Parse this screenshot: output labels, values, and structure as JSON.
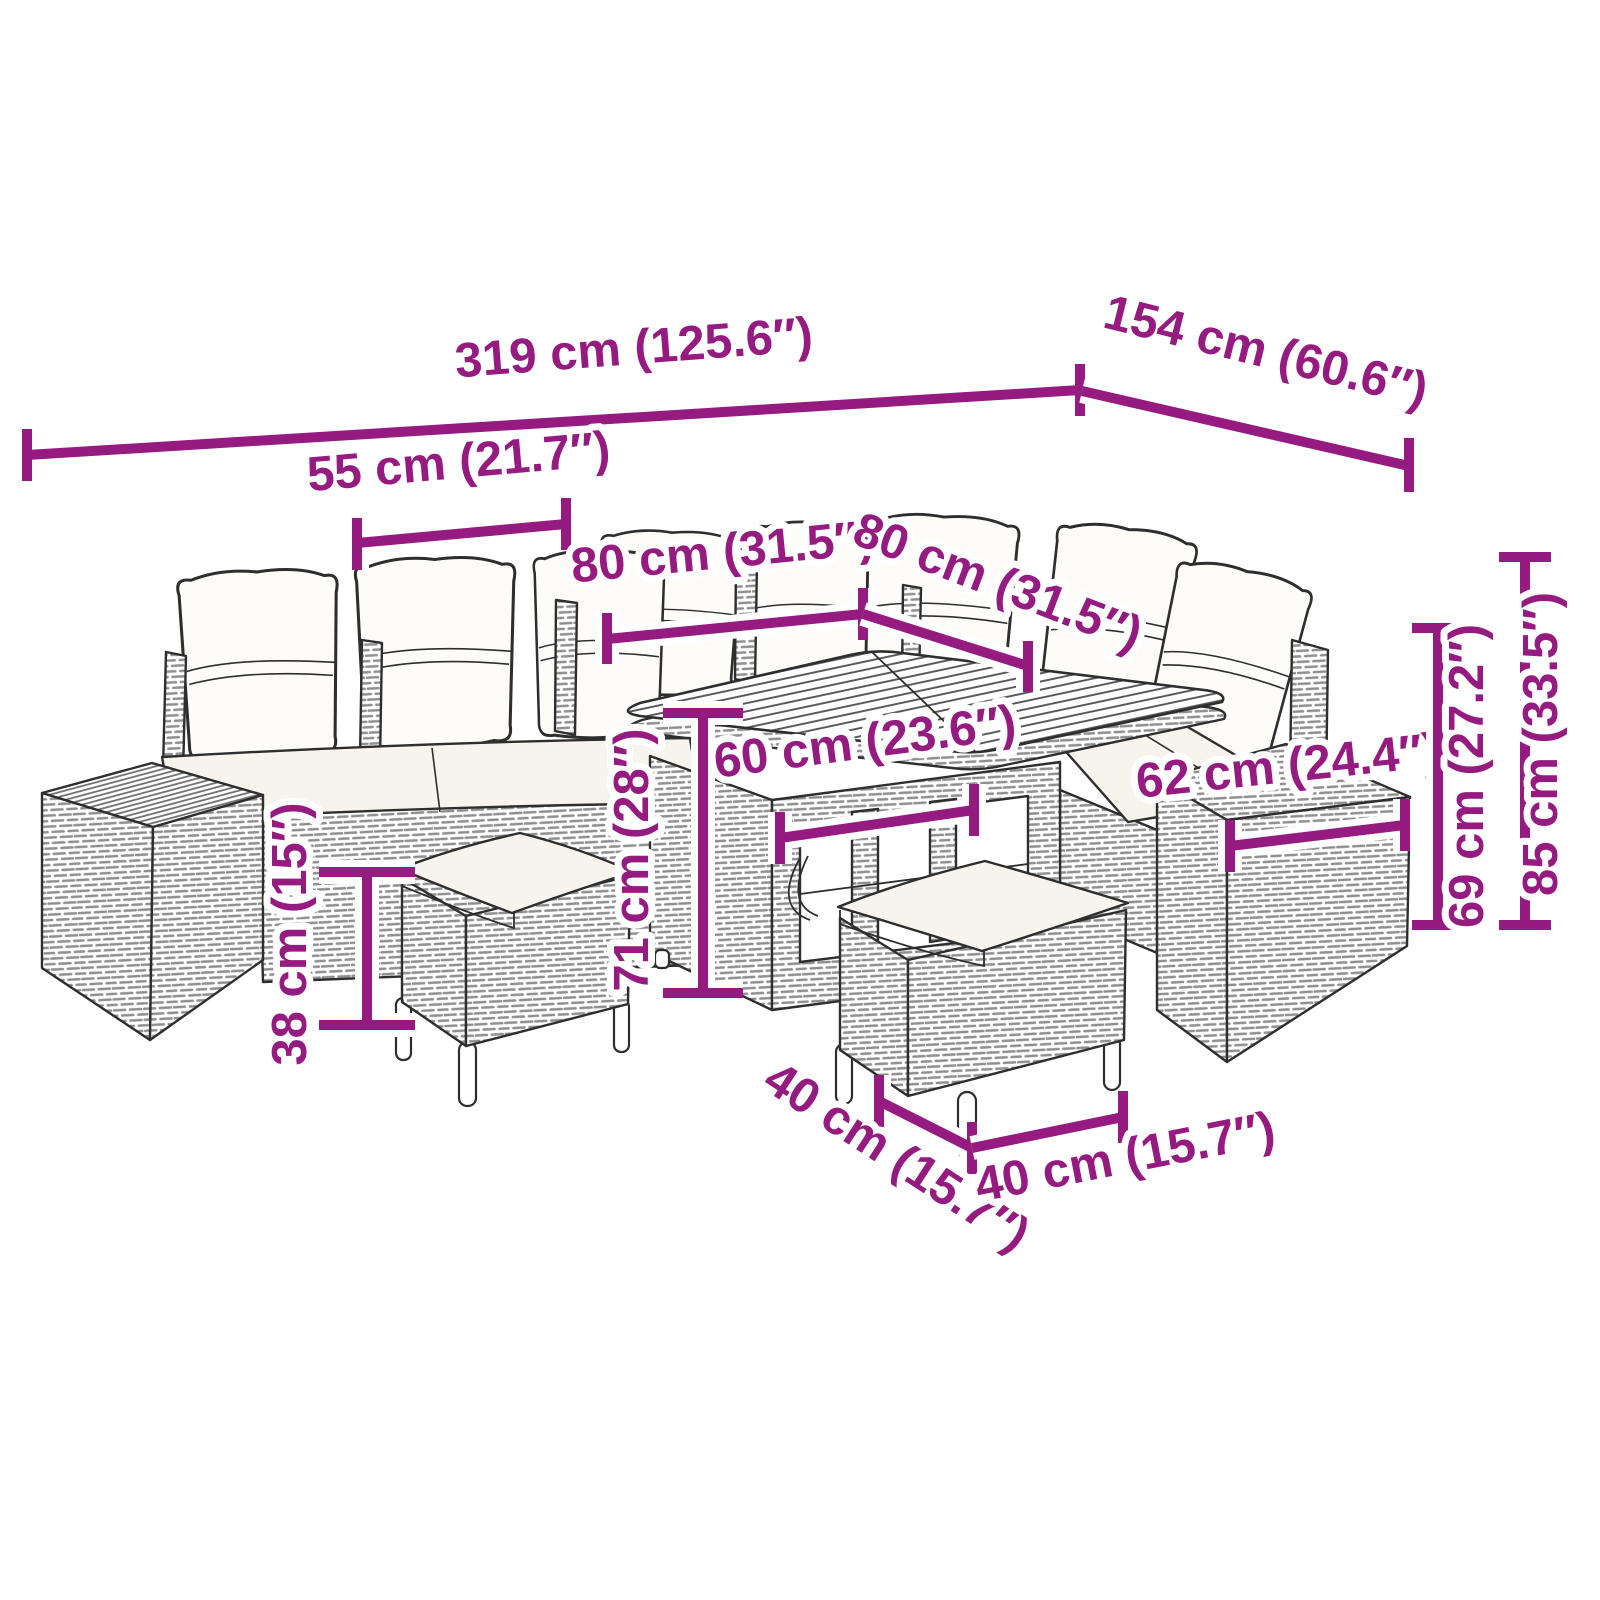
{
  "diagram": {
    "accent_color": "#951B81",
    "art_color": "#2E2E2E",
    "background_color": "#FFFFFF"
  },
  "dimensions": {
    "overall_width": "319 cm (125.6″)",
    "overall_depth": "154 cm (60.6″)",
    "seat_width": "55 cm (21.7″)",
    "table_length": "80 cm (31.5″)",
    "table_depth": "80 cm (31.5″)",
    "tabletop_width": "60 cm (23.6″)",
    "table_height": "71 cm (28″)",
    "stool_height": "38 cm (15″)",
    "armrest_depth": "62 cm (24.4″)",
    "backrest_height": "69 cm (27.2″)",
    "overall_height": "85 cm (33.5″)",
    "stool_width": "40 cm (15.7″)",
    "stool_depth": "40 cm (15.7″)"
  }
}
